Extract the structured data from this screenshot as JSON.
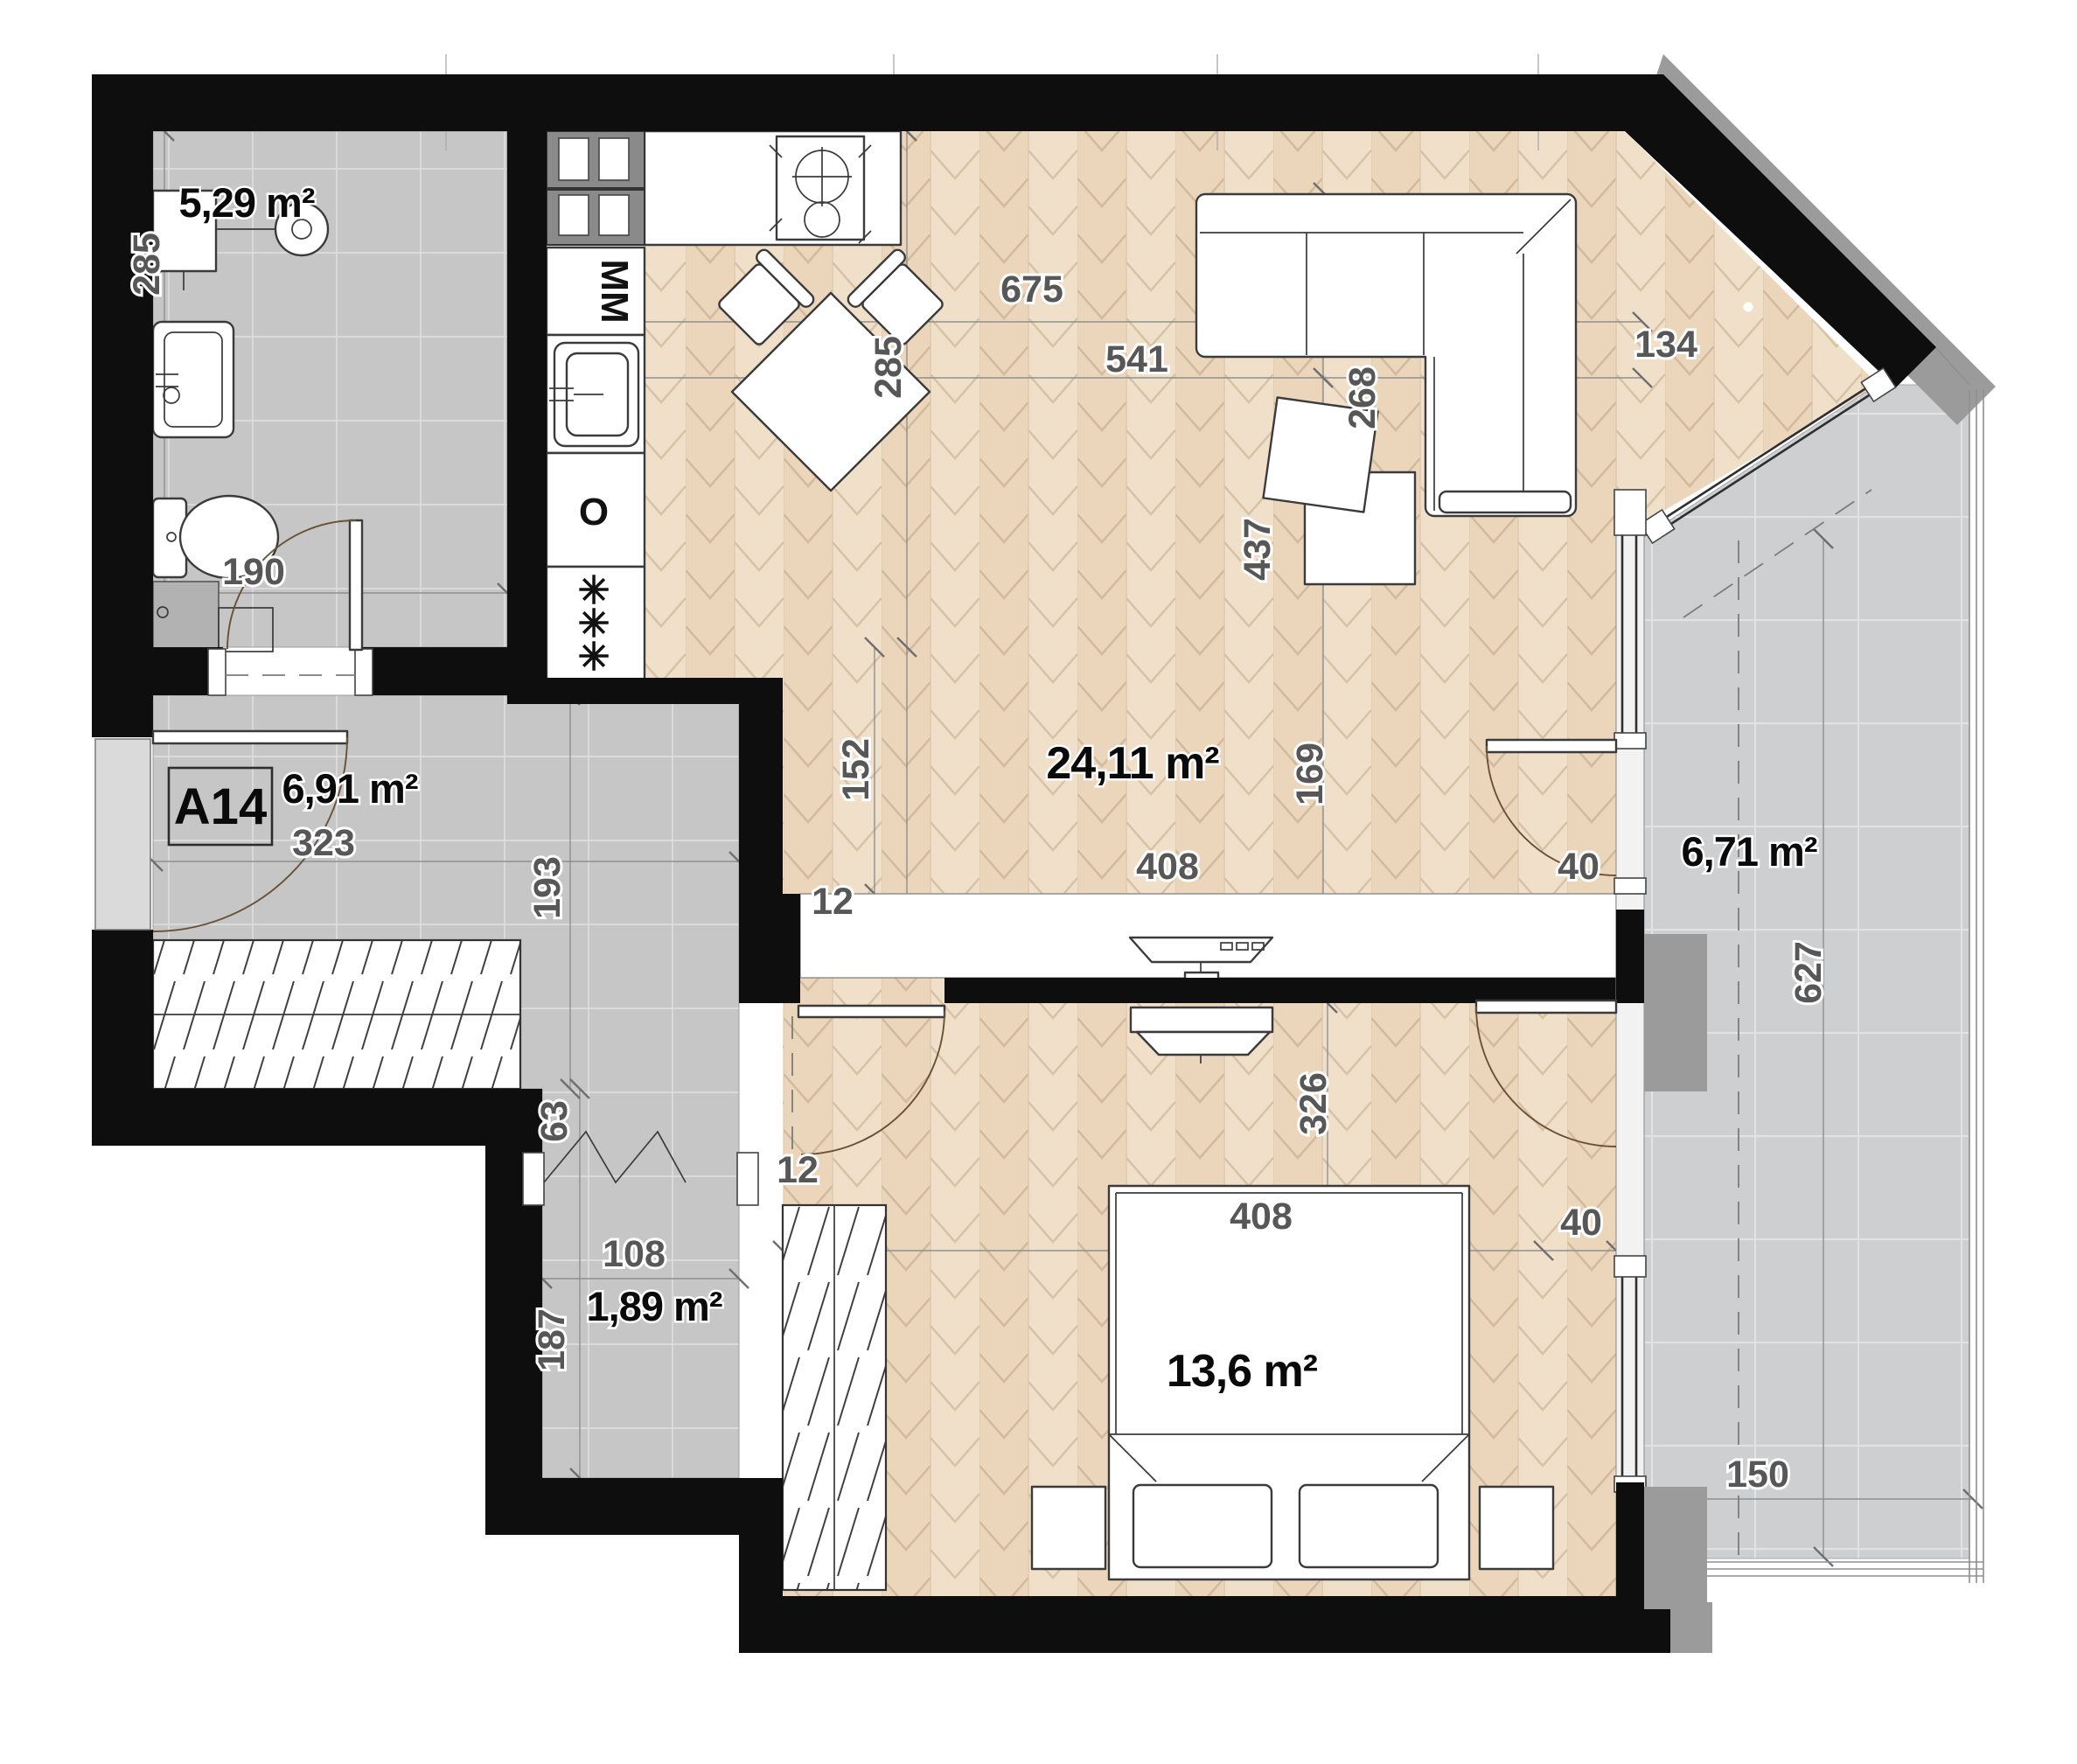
{
  "title": "Apartment floor plan",
  "unit": {
    "label": "A14"
  },
  "rooms": {
    "bathroom": {
      "area": "5,29 m²"
    },
    "hallway": {
      "area": "6,91 m²"
    },
    "closet": {
      "area": "1,89 m²"
    },
    "living": {
      "area": "24,11 m²"
    },
    "bedroom": {
      "area": "13,6 m²"
    },
    "balcony": {
      "area": "6,71 m²"
    }
  },
  "appliances": {
    "washing_machine": "MM",
    "oven": "O",
    "dishwasher_star": "✳"
  },
  "dims": {
    "bath_h": "285",
    "bath_door": "190",
    "hall_w": "323",
    "hall_h": "193",
    "niche": "63",
    "closet_w": "108",
    "closet_h": "187",
    "liv_a": "285",
    "liv_b": "541",
    "liv_c": "675",
    "liv_d": "268",
    "liv_e": "134",
    "liv_f": "437",
    "liv_g": "152",
    "liv_h": "169",
    "liv_tv": "408",
    "liv_door": "40",
    "media_gap": "12",
    "bed_gap": "12",
    "bed_w": "408",
    "bed_win": "40",
    "bed_h": "326",
    "balc_l": "627",
    "balc_w": "150"
  },
  "colors": {
    "wall": "#0e0e0e",
    "wood_floor": "#ecd9c3",
    "tile_floor": "#c6c6c6",
    "balcony_tile": "#cdcfd1",
    "outer_band": "#9b9b9b",
    "dim_text": "#575757"
  }
}
